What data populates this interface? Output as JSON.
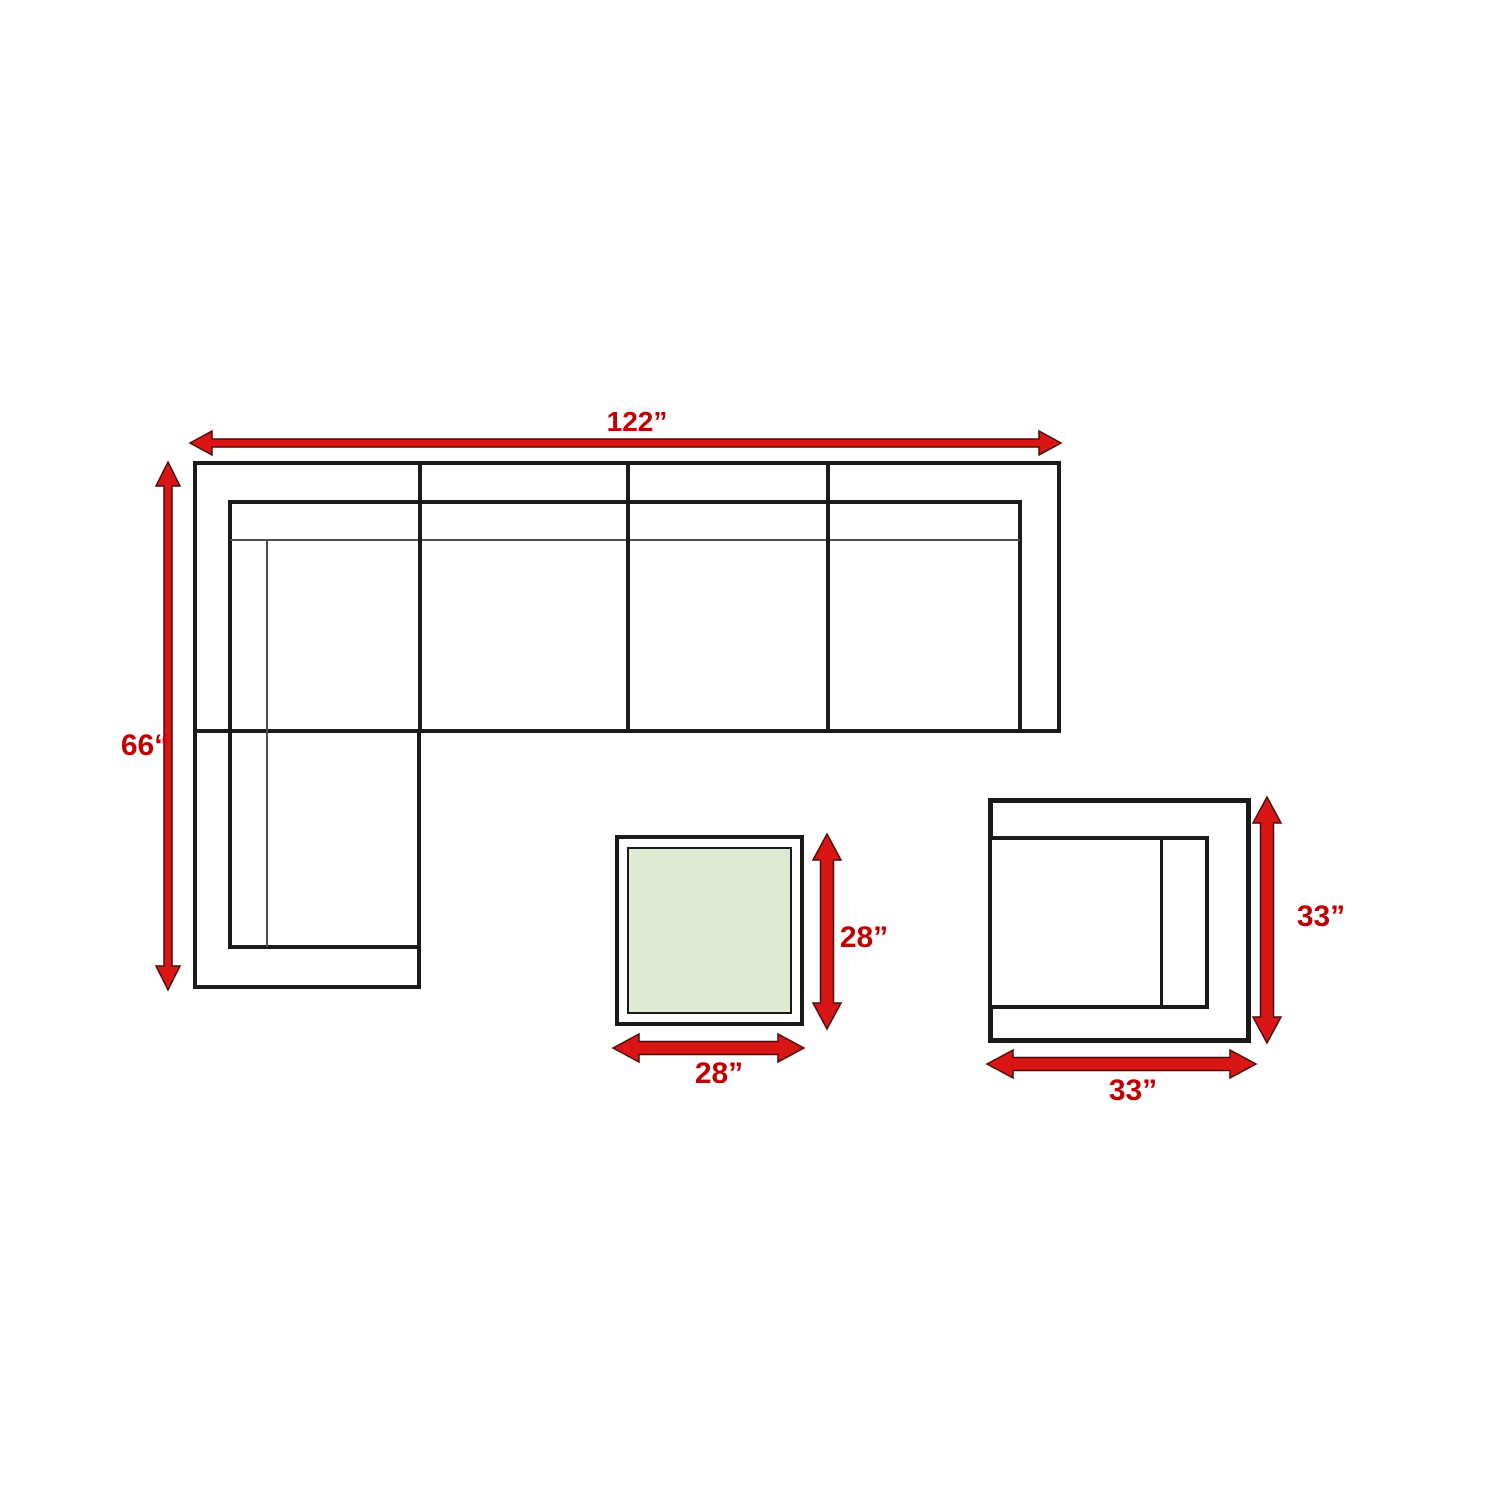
{
  "diagram_labels": {
    "sofa_width": "122”",
    "sofa_depth": "66“",
    "table_depth": "28”",
    "table_width": "28”",
    "chair_depth": "33”",
    "chair_width": "33”"
  },
  "icons": {
    "sofa_width_arrow": "horizontal-double-arrow",
    "sofa_depth_arrow": "vertical-double-arrow",
    "table_depth_arrow": "vertical-double-arrow",
    "table_width_arrow": "horizontal-double-arrow",
    "chair_depth_arrow": "vertical-double-arrow",
    "chair_width_arrow": "horizontal-double-arrow"
  },
  "colors": {
    "dimension_text": "#c00000",
    "arrow_fill": "#da1515",
    "arrow_outline": "#4a0e0e",
    "furniture_outline": "#1a1a1a",
    "furniture_thin_line": "#4d4d4d",
    "table_glass": "#dfead4",
    "background": "#ffffff"
  }
}
